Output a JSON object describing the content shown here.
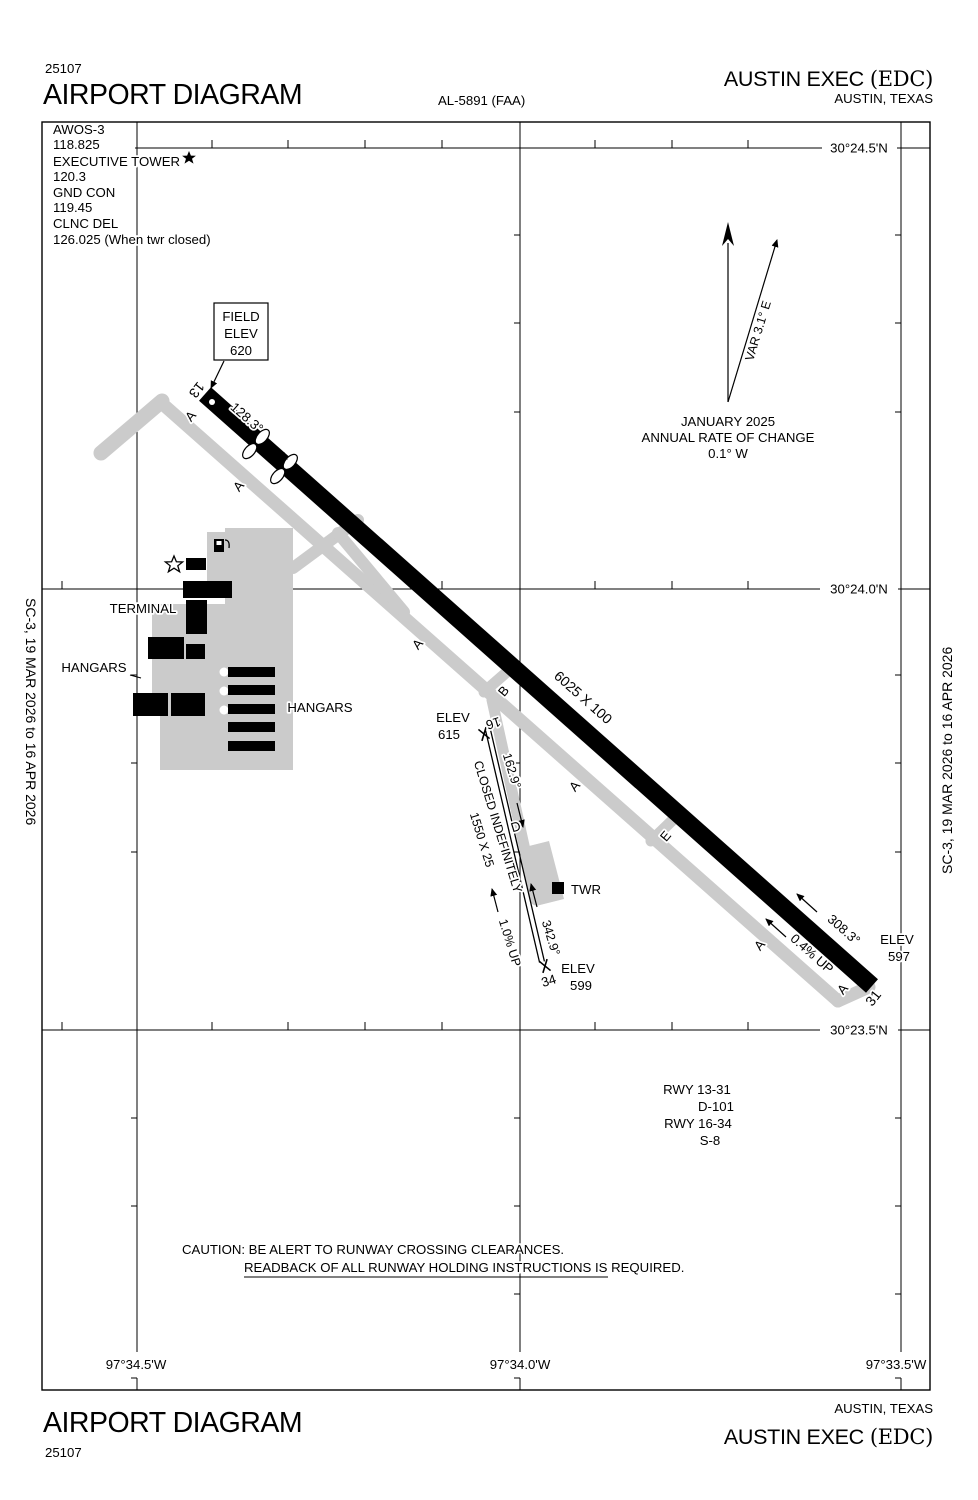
{
  "colors": {
    "ink": "#000000",
    "taxiway_gray": "#cbcbcb",
    "background": "#ffffff"
  },
  "header": {
    "chart_number": "25107",
    "title": "AIRPORT DIAGRAM",
    "procedure_id": "AL-5891 (FAA)",
    "airport_name": "AUSTIN EXEC",
    "airport_icao": "(EDC)",
    "city_state": "AUSTIN, TEXAS"
  },
  "footer": {
    "chart_number": "25107",
    "title": "AIRPORT DIAGRAM",
    "airport_name": "AUSTIN EXEC",
    "airport_icao": "(EDC)",
    "city_state": "AUSTIN, TEXAS"
  },
  "margin_note": "SC-3,  19 MAR 2026  to  16 APR 2026",
  "frequencies": {
    "awos_label": "AWOS-3",
    "awos_freq": "118.825",
    "tower_label": "EXECUTIVE TOWER",
    "tower_freq": "120.3",
    "ground_label": "GND CON",
    "ground_freq": "119.45",
    "clearance_label": "CLNC DEL",
    "clearance_freq": "126.025 (When twr closed)"
  },
  "graticule": {
    "lat": [
      "30°24.5'N",
      "30°24.0'N",
      "30°23.5'N"
    ],
    "lon": [
      "97°34.5'W",
      "97°34.0'W",
      "97°33.5'W"
    ]
  },
  "field_elevation": {
    "line1": "FIELD",
    "line2": "ELEV",
    "value": "620"
  },
  "magnetic_variation": {
    "var": "VAR 3.1° E",
    "date": "JANUARY 2025",
    "note": "ANNUAL RATE OF CHANGE",
    "rate": "0.1° W"
  },
  "runway_13_31": {
    "number_13": "13",
    "number_31": "31",
    "heading_13": "128.3°",
    "heading_31": "308.3°",
    "dimensions": "6025 X 100",
    "gradient": "0.4% UP",
    "elev_label": "ELEV",
    "elev_31": "597"
  },
  "runway_16_34": {
    "number_16": "16",
    "number_34": "34",
    "heading_16": "162.9°",
    "heading_34": "342.9°",
    "dimensions": "1550 X 25",
    "status": "CLOSED INDEFINITELY",
    "gradient": "1.0% UP",
    "elev_label": "ELEV",
    "elev_16": "615",
    "elev_34": "599"
  },
  "taxiways": {
    "a": "A",
    "b": "B",
    "d": "D",
    "e": "E"
  },
  "facilities": {
    "terminal": "TERMINAL",
    "hangars_west": "HANGARS",
    "hangars_east": "HANGARS",
    "tower": "TWR"
  },
  "runway_data": {
    "line1": "RWY 13-31",
    "line2": "D-101",
    "line3": "RWY 16-34",
    "line4": "S-8"
  },
  "caution": {
    "line1": "CAUTION: BE ALERT TO RUNWAY CROSSING CLEARANCES.",
    "line2": "READBACK OF ALL RUNWAY HOLDING INSTRUCTIONS IS REQUIRED."
  }
}
